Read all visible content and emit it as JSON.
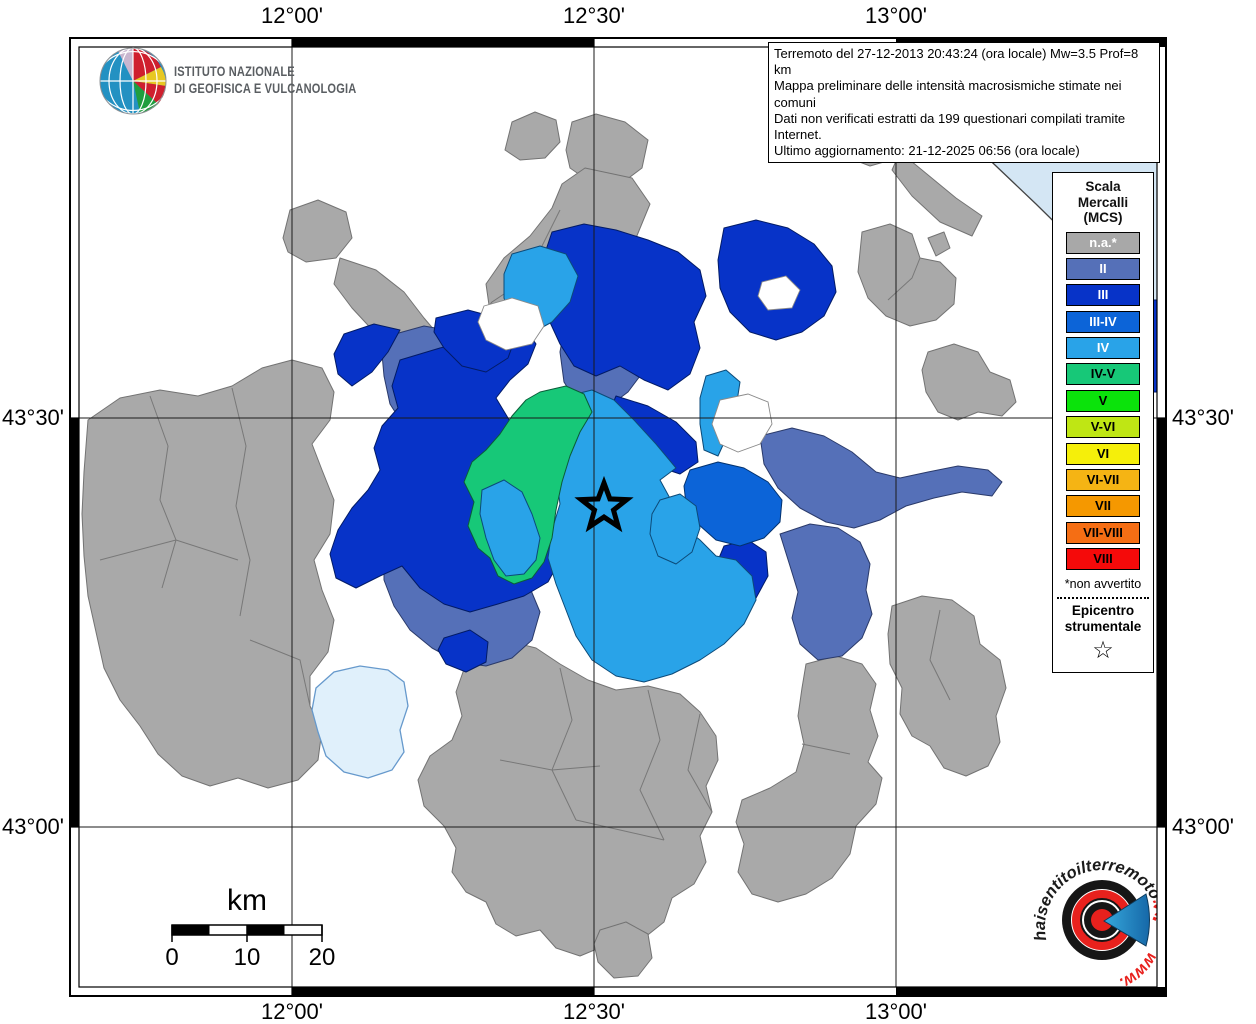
{
  "header": {
    "lon_labels": [
      "12°00'",
      "12°30'",
      "13°00'"
    ],
    "lat_labels": [
      "43°30'",
      "43°00'"
    ]
  },
  "info_box": {
    "lines": [
      "Terremoto del 27-12-2013 20:43:24 (ora locale) Mw=3.5 Prof=8 km",
      "Mappa preliminare delle intensità macrosismiche stimate nei comuni",
      "Dati non verificati estratti da 199 questionari compilati tramite Internet.",
      "Ultimo aggiornamento: 21-12-2025 06:56 (ora locale)"
    ]
  },
  "ingv": {
    "name_line1": "ISTITUTO NAZIONALE",
    "name_line2": "DI GEOFISICA E VULCANOLOGIA"
  },
  "legend": {
    "title": "Scala\nMercalli\n(MCS)",
    "items": [
      {
        "label": "n.a.*",
        "color": "#a8a8a8",
        "text_color": "#ffffff"
      },
      {
        "label": "II",
        "color": "#5570b8",
        "text_color": "#ffffff"
      },
      {
        "label": "III",
        "color": "#0733c8",
        "text_color": "#ffffff"
      },
      {
        "label": "III-IV",
        "color": "#0c64d8",
        "text_color": "#ffffff"
      },
      {
        "label": "IV",
        "color": "#29a3e8",
        "text_color": "#ffffff"
      },
      {
        "label": "IV-V",
        "color": "#17c878",
        "text_color": "#000000"
      },
      {
        "label": "V",
        "color": "#0be30b",
        "text_color": "#000000"
      },
      {
        "label": "V-VI",
        "color": "#bfe614",
        "text_color": "#000000"
      },
      {
        "label": "VI",
        "color": "#f5ef0a",
        "text_color": "#000000"
      },
      {
        "label": "VI-VII",
        "color": "#f5b414",
        "text_color": "#000000"
      },
      {
        "label": "VII",
        "color": "#f59800",
        "text_color": "#000000"
      },
      {
        "label": "VII-VIII",
        "color": "#f56e14",
        "text_color": "#000000"
      },
      {
        "label": "VIII",
        "color": "#f50a0a",
        "text_color": "#000000"
      }
    ],
    "footnote": "*non avvertito",
    "epicenter_title": "Epicentro\nstrumentale",
    "epicenter_symbol": "☆"
  },
  "scale_bar": {
    "unit": "km",
    "ticks": [
      "0",
      "10",
      "20"
    ]
  },
  "brand": {
    "arc_main": "haisentitoilterremoto",
    "arc_suffix": ".it",
    "arc_bottom": "www.",
    "question_mark": "?"
  }
}
